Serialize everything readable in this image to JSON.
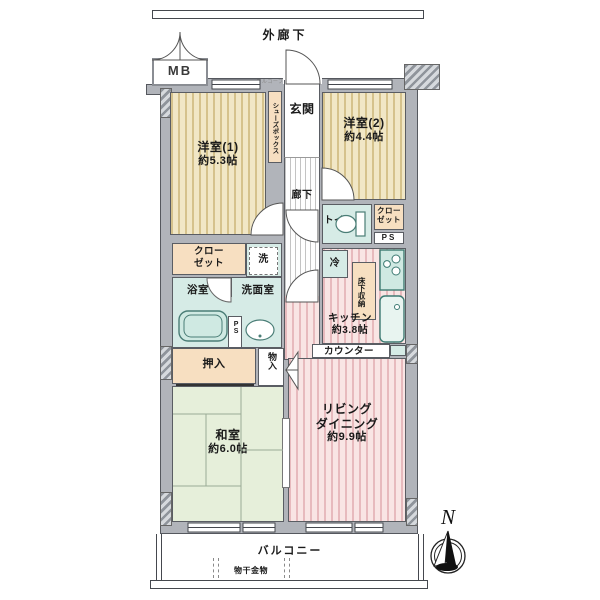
{
  "title": "マンション間取り図",
  "labels": {
    "outer_corridor": "外廊下",
    "mb": "MB",
    "alcove": "アルコーブ",
    "entrance": "玄関",
    "shoes_box": "シューズボックス",
    "hallway": "廊下",
    "room1_name": "洋室(1)",
    "room1_size": "約5.3帖",
    "room2_name": "洋室(2)",
    "room2_size": "約4.4帖",
    "toilet": "トイレ",
    "closet_r1": "クロー",
    "closet_r2": "ゼット",
    "ps_right": "PS",
    "closet_l1": "クロー",
    "closet_l2": "ゼット",
    "washer": "洗",
    "bath": "浴室",
    "washroom": "洗面室",
    "ps_left": "PS",
    "fridge": "冷",
    "underfloor": "床下収納",
    "kitchen_name": "キッチン",
    "kitchen_size": "約3.8帖",
    "counter": "カウンター",
    "living1": "リビング",
    "living2": "ダイニング",
    "living_size": "約9.9帖",
    "oshiire": "押入",
    "storage": "物入",
    "tatami_name": "和室",
    "tatami_size": "約6.0帖",
    "balcony": "バルコニー",
    "laundry_fitting": "物干金物",
    "compass_n": "N"
  },
  "colors": {
    "wall_gray": "#b1b4ba",
    "western_room_beige": "#f1e7c6",
    "living_pink": "#f9e5e4",
    "tatami_green": "#e6efda",
    "wet_area_teal": "#d6ebe6",
    "closet_orange": "#f7dfc1",
    "outline": "#55585e"
  }
}
